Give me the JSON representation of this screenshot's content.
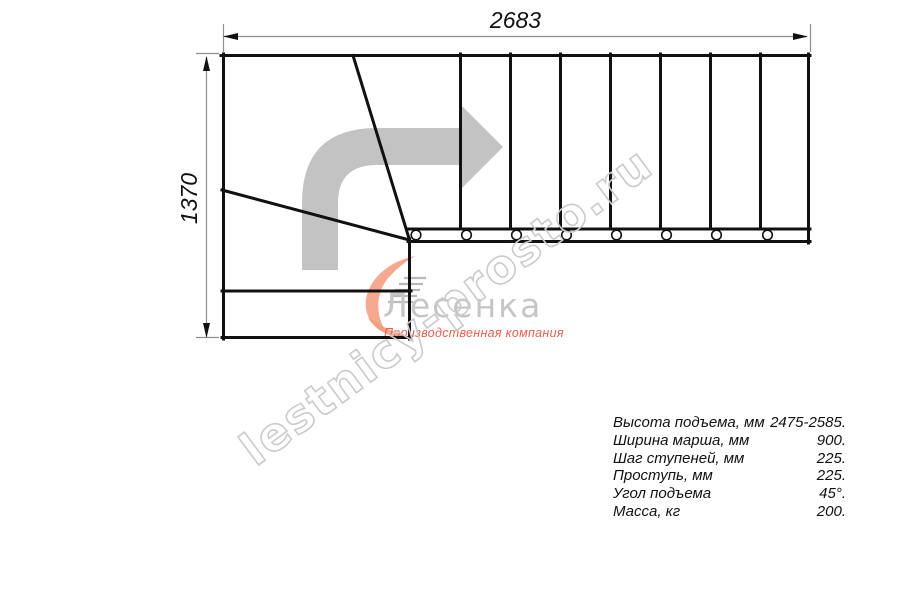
{
  "drawing": {
    "top_dimension": "2683",
    "left_dimension": "1370"
  },
  "watermark": {
    "text": "lestnicy-prosto.ru"
  },
  "logo": {
    "brand": "Лесенка",
    "tagline": "Производственная компания"
  },
  "specs": {
    "rows": [
      {
        "label": "Высота подъема, мм",
        "value": "2475-2585."
      },
      {
        "label": "Ширина марша, мм",
        "value": "900."
      },
      {
        "label": "Шаг ступеней, мм",
        "value": "225."
      },
      {
        "label": "Проступь, мм",
        "value": "225."
      },
      {
        "label": "Угол подъема",
        "value": "45°."
      },
      {
        "label": "Масса, кг",
        "value": "200."
      }
    ]
  },
  "colors": {
    "line": "#111111",
    "dimension": "#8f8f8f",
    "direction_arrow": "#c3c3c3",
    "watermark": "#cbcbcb",
    "logo_accent": "#f39a7c",
    "logo_text": "#c6c6c6",
    "tagline": "#e8604c"
  }
}
